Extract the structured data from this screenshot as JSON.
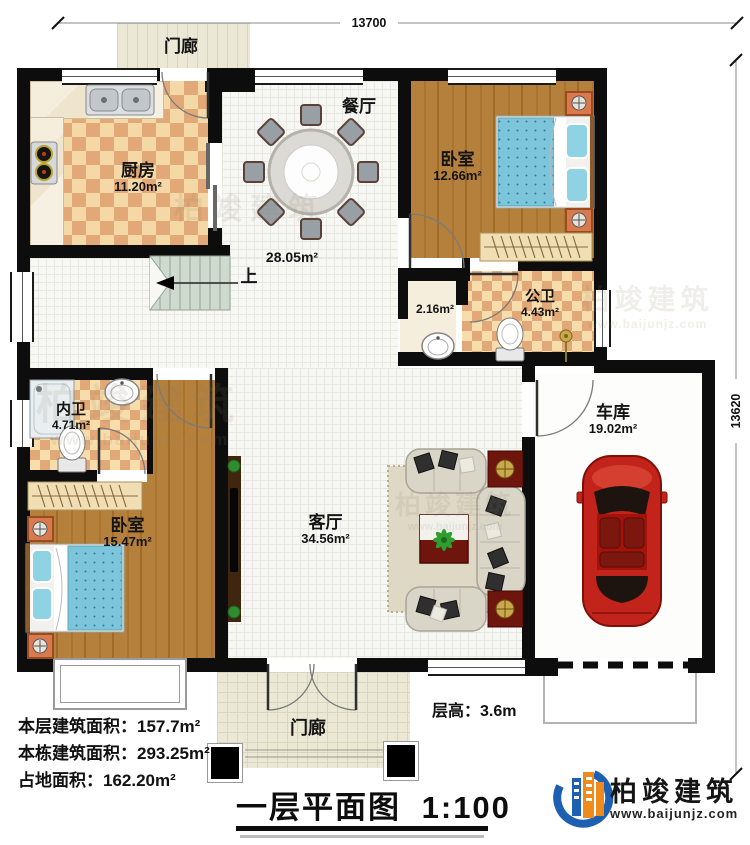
{
  "rooms": {
    "porch_top": {
      "name": "门廊"
    },
    "kitchen": {
      "name": "厨房",
      "area": "11.20m²"
    },
    "dining": {
      "name": "餐厅",
      "area": "28.05m²"
    },
    "bedroom_tr": {
      "name": "卧室",
      "area": "12.66m²"
    },
    "vestibule": {
      "area": "2.16m²"
    },
    "public_bath": {
      "name": "公卫",
      "area": "4.43m²"
    },
    "inner_bath": {
      "name": "内卫",
      "area": "4.71m²"
    },
    "bedroom_bl": {
      "name": "卧室",
      "area": "15.47m²"
    },
    "living": {
      "name": "客厅",
      "area": "34.56m²"
    },
    "garage": {
      "name": "车库",
      "area": "19.02m²"
    },
    "porch_bottom": {
      "name": "门廊"
    }
  },
  "stair": {
    "up": "上"
  },
  "dims": {
    "top": "13700",
    "right": "13620"
  },
  "stats": [
    {
      "label": "本层建筑面积：",
      "value": "157.7m²"
    },
    {
      "label": "本栋建筑面积：",
      "value": "293.25m²"
    },
    {
      "label": "占地面积：",
      "value": "162.20m²"
    }
  ],
  "floor_height": {
    "label": "层高：",
    "value": "3.6m"
  },
  "title": {
    "text": "一层平面图",
    "scale": "1:100"
  },
  "brand": {
    "name": "柏竣建筑",
    "site": "www.baijunjz.com"
  },
  "watermark": {
    "name": "柏竣建筑",
    "site": "www.baijunjz.com"
  },
  "colors": {
    "brand_blue": "#1d5fb0",
    "brand_orange": "#f18a1c",
    "car_red": "#c2231a",
    "wall_black": "#0d0d0d",
    "wood_floor": "#b5803c",
    "bath_checker": "#e2a877"
  }
}
